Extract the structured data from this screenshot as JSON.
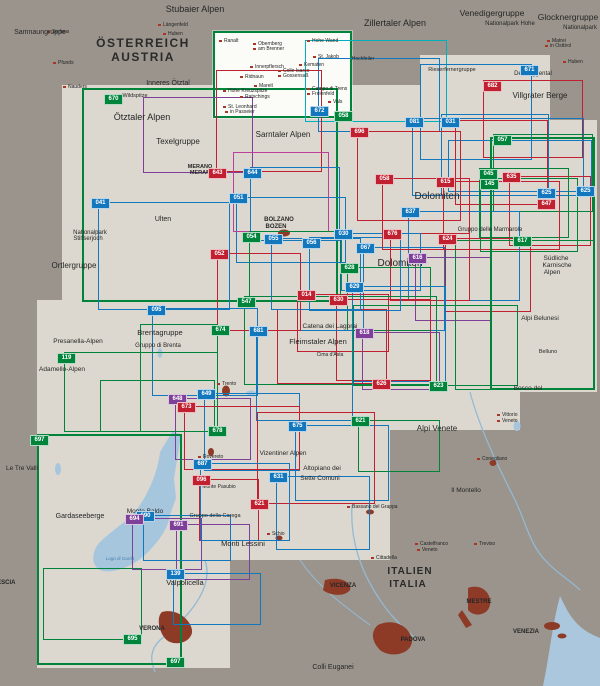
{
  "map_title": "Map sheet index overview – Südtirol / Dolomiten / Gardasee",
  "palette": {
    "b": "#1377bd",
    "r": "#c0202f",
    "g": "#00843c",
    "p": "#7d3f98",
    "m": "#bb3f9b",
    "c": "#00b0bd"
  },
  "water_color": "#a6c6de",
  "city_color": "#8d3a27",
  "coverage": [
    [
      62,
      85,
      483,
      230,
      false
    ],
    [
      37,
      300,
      483,
      130,
      false
    ],
    [
      37,
      430,
      353,
      130,
      false
    ],
    [
      37,
      560,
      193,
      108,
      false
    ],
    [
      420,
      55,
      130,
      90,
      false
    ],
    [
      448,
      120,
      149,
      272,
      false
    ],
    [
      213,
      31,
      139,
      87,
      true
    ]
  ],
  "sheets": [
    {
      "c": "g",
      "x": 213,
      "y": 31,
      "w": 139,
      "h": 87,
      "bw": 2
    },
    {
      "c": "g",
      "x": 82,
      "y": 88,
      "w": 256,
      "h": 214,
      "bw": 2
    },
    {
      "c": "c",
      "x": 305,
      "y": 40,
      "w": 142,
      "h": 82
    },
    {
      "c": "b",
      "x": 318,
      "y": 58,
      "w": 122,
      "h": 74
    },
    {
      "c": "r",
      "x": 216,
      "y": 70,
      "w": 106,
      "h": 102
    },
    {
      "c": "b",
      "x": 420,
      "y": 64,
      "w": 112,
      "h": 96
    },
    {
      "c": "r",
      "x": 483,
      "y": 80,
      "w": 100,
      "h": 78
    },
    {
      "c": "b",
      "x": 412,
      "y": 118,
      "w": 172,
      "h": 78
    },
    {
      "c": "b",
      "x": 441,
      "y": 114,
      "w": 108,
      "h": 82
    },
    {
      "c": "b",
      "x": 448,
      "y": 140,
      "w": 144,
      "h": 52
    },
    {
      "c": "r",
      "x": 455,
      "y": 120,
      "w": 93,
      "h": 85
    },
    {
      "c": "g",
      "x": 493,
      "y": 134,
      "w": 100,
      "h": 78
    },
    {
      "c": "r",
      "x": 509,
      "y": 176,
      "w": 82,
      "h": 70
    },
    {
      "c": "g",
      "x": 479,
      "y": 168,
      "w": 90,
      "h": 70
    },
    {
      "c": "g",
      "x": 480,
      "y": 178,
      "w": 98,
      "h": 74
    },
    {
      "c": "r",
      "x": 443,
      "y": 181,
      "w": 117,
      "h": 69
    },
    {
      "c": "b",
      "x": 408,
      "y": 211,
      "w": 112,
      "h": 90
    },
    {
      "c": "r",
      "x": 445,
      "y": 238,
      "w": 86,
      "h": 74
    },
    {
      "c": "p",
      "x": 415,
      "y": 257,
      "w": 76,
      "h": 64
    },
    {
      "c": "g",
      "x": 455,
      "y": 240,
      "w": 140,
      "h": 150
    },
    {
      "c": "g",
      "x": 490,
      "y": 137,
      "w": 105,
      "h": 253,
      "bw": 2.5
    },
    {
      "c": "r",
      "x": 390,
      "y": 233,
      "w": 80,
      "h": 68
    },
    {
      "c": "b",
      "x": 341,
      "y": 233,
      "w": 80,
      "h": 58
    },
    {
      "c": "b",
      "x": 363,
      "y": 247,
      "w": 82,
      "h": 84
    },
    {
      "c": "g",
      "x": 347,
      "y": 267,
      "w": 84,
      "h": 64
    },
    {
      "c": "b",
      "x": 352,
      "y": 286,
      "w": 94,
      "h": 96
    },
    {
      "c": "r",
      "x": 336,
      "y": 299,
      "w": 95,
      "h": 82
    },
    {
      "c": "r",
      "x": 297,
      "y": 294,
      "w": 92,
      "h": 58
    },
    {
      "c": "p",
      "x": 362,
      "y": 332,
      "w": 78,
      "h": 58
    },
    {
      "c": "r",
      "x": 277,
      "y": 309,
      "w": 110,
      "h": 75
    },
    {
      "c": "g",
      "x": 244,
      "y": 296,
      "w": 193,
      "h": 89
    },
    {
      "c": "g",
      "x": 353,
      "y": 305,
      "w": 165,
      "h": 81
    },
    {
      "c": "b",
      "x": 256,
      "y": 330,
      "w": 97,
      "h": 91
    },
    {
      "c": "b",
      "x": 236,
      "y": 197,
      "w": 110,
      "h": 66
    },
    {
      "c": "b",
      "x": 271,
      "y": 238,
      "w": 90,
      "h": 72
    },
    {
      "c": "b",
      "x": 309,
      "y": 237,
      "w": 92,
      "h": 74
    },
    {
      "c": "b",
      "x": 250,
      "y": 167,
      "w": 90,
      "h": 74
    },
    {
      "c": "r",
      "x": 357,
      "y": 131,
      "w": 104,
      "h": 90
    },
    {
      "c": "r",
      "x": 382,
      "y": 178,
      "w": 88,
      "h": 72
    },
    {
      "c": "r",
      "x": 217,
      "y": 253,
      "w": 84,
      "h": 78
    },
    {
      "c": "p",
      "x": 143,
      "y": 97,
      "w": 110,
      "h": 76
    },
    {
      "c": "m",
      "x": 233,
      "y": 152,
      "w": 96,
      "h": 80
    },
    {
      "c": "b",
      "x": 98,
      "y": 202,
      "w": 132,
      "h": 108
    },
    {
      "c": "b",
      "x": 152,
      "y": 308,
      "w": 106,
      "h": 88
    },
    {
      "c": "g",
      "x": 249,
      "y": 231,
      "w": 92,
      "h": 70
    },
    {
      "c": "g",
      "x": 64,
      "y": 352,
      "w": 154,
      "h": 80
    },
    {
      "c": "g",
      "x": 140,
      "y": 324,
      "w": 78,
      "h": 108
    },
    {
      "c": "b",
      "x": 204,
      "y": 393,
      "w": 96,
      "h": 78
    },
    {
      "c": "p",
      "x": 175,
      "y": 398,
      "w": 76,
      "h": 62
    },
    {
      "c": "r",
      "x": 184,
      "y": 406,
      "w": 116,
      "h": 64
    },
    {
      "c": "g",
      "x": 100,
      "y": 380,
      "w": 115,
      "h": 52
    },
    {
      "c": "g",
      "x": 37,
      "y": 434,
      "w": 145,
      "h": 231,
      "bw": 2.5
    },
    {
      "c": "g",
      "x": 43,
      "y": 568,
      "w": 99,
      "h": 72
    },
    {
      "c": "b",
      "x": 295,
      "y": 425,
      "w": 94,
      "h": 76
    },
    {
      "c": "g",
      "x": 358,
      "y": 420,
      "w": 82,
      "h": 52
    },
    {
      "c": "r",
      "x": 257,
      "y": 412,
      "w": 118,
      "h": 92
    },
    {
      "c": "r",
      "x": 199,
      "y": 479,
      "w": 60,
      "h": 62
    },
    {
      "c": "b",
      "x": 200,
      "y": 463,
      "w": 90,
      "h": 78
    },
    {
      "c": "b",
      "x": 276,
      "y": 476,
      "w": 94,
      "h": 74
    },
    {
      "c": "b",
      "x": 143,
      "y": 515,
      "w": 88,
      "h": 46
    },
    {
      "c": "p",
      "x": 132,
      "y": 518,
      "w": 70,
      "h": 52
    },
    {
      "c": "p",
      "x": 176,
      "y": 524,
      "w": 74,
      "h": 56
    },
    {
      "c": "b",
      "x": 173,
      "y": 573,
      "w": 88,
      "h": 52
    }
  ],
  "badges": [
    {
      "n": "670",
      "c": "g",
      "x": 104,
      "y": 94
    },
    {
      "n": "672",
      "c": "b",
      "x": 310,
      "y": 106
    },
    {
      "n": "058",
      "c": "g",
      "x": 334,
      "y": 111
    },
    {
      "n": "671",
      "c": "b",
      "x": 520,
      "y": 65
    },
    {
      "n": "682",
      "c": "r",
      "x": 483,
      "y": 81
    },
    {
      "n": "643",
      "c": "r",
      "x": 208,
      "y": 168
    },
    {
      "n": "644",
      "c": "b",
      "x": 243,
      "y": 168
    },
    {
      "n": "696",
      "c": "r",
      "x": 350,
      "y": 127
    },
    {
      "n": "081",
      "c": "b",
      "x": 405,
      "y": 117
    },
    {
      "n": "031",
      "c": "b",
      "x": 441,
      "y": 117
    },
    {
      "n": "057",
      "c": "g",
      "x": 493,
      "y": 135
    },
    {
      "n": "635",
      "c": "r",
      "x": 502,
      "y": 172
    },
    {
      "n": "045",
      "c": "g",
      "x": 479,
      "y": 169
    },
    {
      "n": "145",
      "c": "g",
      "x": 480,
      "y": 179
    },
    {
      "n": "625",
      "c": "b",
      "x": 537,
      "y": 188
    },
    {
      "n": "625",
      "c": "b",
      "x": 576,
      "y": 186
    },
    {
      "n": "647",
      "c": "r",
      "x": 537,
      "y": 199
    },
    {
      "n": "615",
      "c": "r",
      "x": 436,
      "y": 177
    },
    {
      "n": "637",
      "c": "b",
      "x": 401,
      "y": 207
    },
    {
      "n": "058",
      "c": "r",
      "x": 375,
      "y": 174
    },
    {
      "n": "041",
      "c": "b",
      "x": 91,
      "y": 198
    },
    {
      "n": "051",
      "c": "b",
      "x": 229,
      "y": 193
    },
    {
      "n": "054",
      "c": "g",
      "x": 242,
      "y": 232
    },
    {
      "n": "055",
      "c": "b",
      "x": 264,
      "y": 234
    },
    {
      "n": "056",
      "c": "b",
      "x": 302,
      "y": 238
    },
    {
      "n": "030",
      "c": "b",
      "x": 334,
      "y": 229
    },
    {
      "n": "067",
      "c": "b",
      "x": 356,
      "y": 243
    },
    {
      "n": "676",
      "c": "r",
      "x": 383,
      "y": 229
    },
    {
      "n": "624",
      "c": "r",
      "x": 438,
      "y": 234
    },
    {
      "n": "616",
      "c": "p",
      "x": 408,
      "y": 253
    },
    {
      "n": "617",
      "c": "g",
      "x": 513,
      "y": 236
    },
    {
      "n": "628",
      "c": "g",
      "x": 340,
      "y": 263
    },
    {
      "n": "629",
      "c": "b",
      "x": 345,
      "y": 282
    },
    {
      "n": "630",
      "c": "r",
      "x": 329,
      "y": 295
    },
    {
      "n": "014",
      "c": "r",
      "x": 297,
      "y": 290
    },
    {
      "n": "618",
      "c": "p",
      "x": 355,
      "y": 328
    },
    {
      "n": "547",
      "c": "g",
      "x": 237,
      "y": 297
    },
    {
      "n": "681",
      "c": "b",
      "x": 249,
      "y": 326
    },
    {
      "n": "674",
      "c": "g",
      "x": 211,
      "y": 325
    },
    {
      "n": "052",
      "c": "r",
      "x": 210,
      "y": 249
    },
    {
      "n": "095",
      "c": "b",
      "x": 147,
      "y": 305
    },
    {
      "n": "119",
      "c": "g",
      "x": 57,
      "y": 353
    },
    {
      "n": "649",
      "c": "b",
      "x": 197,
      "y": 389
    },
    {
      "n": "648",
      "c": "p",
      "x": 168,
      "y": 394
    },
    {
      "n": "673",
      "c": "r",
      "x": 177,
      "y": 402
    },
    {
      "n": "678",
      "c": "g",
      "x": 208,
      "y": 426
    },
    {
      "n": "626",
      "c": "r",
      "x": 372,
      "y": 379
    },
    {
      "n": "623",
      "c": "g",
      "x": 429,
      "y": 381
    },
    {
      "n": "621",
      "c": "g",
      "x": 351,
      "y": 416
    },
    {
      "n": "675",
      "c": "b",
      "x": 288,
      "y": 421
    },
    {
      "n": "687",
      "c": "b",
      "x": 193,
      "y": 459
    },
    {
      "n": "096",
      "c": "r",
      "x": 192,
      "y": 475
    },
    {
      "n": "631",
      "c": "b",
      "x": 269,
      "y": 472
    },
    {
      "n": "690",
      "c": "b",
      "x": 136,
      "y": 511
    },
    {
      "n": "694",
      "c": "p",
      "x": 125,
      "y": 514
    },
    {
      "n": "691",
      "c": "p",
      "x": 169,
      "y": 520
    },
    {
      "n": "621",
      "c": "r",
      "x": 250,
      "y": 499
    },
    {
      "n": "139",
      "c": "b",
      "x": 166,
      "y": 569
    },
    {
      "n": "697",
      "c": "g",
      "x": 30,
      "y": 435
    },
    {
      "n": "697",
      "c": "g",
      "x": 166,
      "y": 657
    },
    {
      "n": "695",
      "c": "g",
      "x": 123,
      "y": 634
    }
  ],
  "labels": [
    {
      "t": "Stubaier Alpen",
      "x": 195,
      "y": 4,
      "s": 9
    },
    {
      "t": "Zillertaler Alpen",
      "x": 395,
      "y": 18,
      "s": 9
    },
    {
      "t": "Venedigergruppe",
      "x": 492,
      "y": 8,
      "s": 8.5
    },
    {
      "t": "Glocknergruppe",
      "x": 568,
      "y": 12,
      "s": 8.5
    },
    {
      "t": "Nationalpark Hohe",
      "x": 510,
      "y": 21,
      "s": 6
    },
    {
      "t": "Nationalpark",
      "x": 580,
      "y": 25,
      "s": 6
    },
    {
      "t": "Samnaungruppe",
      "x": 40,
      "y": 29,
      "s": 7
    },
    {
      "t": "ÖSTERREICH",
      "x": 143,
      "y": 36,
      "s": 12,
      "w": "600",
      "sp": 1.5,
      "c": "#2a2a2a"
    },
    {
      "t": "AUSTRIA",
      "x": 143,
      "y": 50,
      "s": 12,
      "w": "600",
      "sp": 1.5,
      "c": "#2a2a2a"
    },
    {
      "t": "Inneres Ötztal",
      "x": 168,
      "y": 80,
      "s": 7
    },
    {
      "t": "Wildspitze",
      "x": 135,
      "y": 93,
      "s": 5.5
    },
    {
      "t": "Ötztaler Alpen",
      "x": 142,
      "y": 112,
      "s": 9
    },
    {
      "t": "Texelgruppe",
      "x": 178,
      "y": 137,
      "s": 8
    },
    {
      "t": "Sarntaler Alpen",
      "x": 283,
      "y": 130,
      "s": 8
    },
    {
      "t": "MERANO",
      "x": 200,
      "y": 164,
      "s": 5.5,
      "w": "bold"
    },
    {
      "t": "MERAN",
      "x": 200,
      "y": 170,
      "s": 5.5,
      "w": "bold"
    },
    {
      "t": "Villgrater Berge",
      "x": 540,
      "y": 91,
      "s": 8
    },
    {
      "t": "Defereggental",
      "x": 533,
      "y": 71,
      "s": 6
    },
    {
      "t": "Rieserfernergruppe",
      "x": 452,
      "y": 67,
      "s": 5.5
    },
    {
      "t": "Hochfeiler",
      "x": 363,
      "y": 56,
      "s": 5
    },
    {
      "t": "Ortlergruppe",
      "x": 74,
      "y": 261,
      "s": 8
    },
    {
      "t": "Nationalpark",
      "x": 90,
      "y": 230,
      "s": 6
    },
    {
      "t": "Stilfserjoch",
      "x": 88,
      "y": 236,
      "s": 6
    },
    {
      "t": "Ulten",
      "x": 163,
      "y": 216,
      "s": 7
    },
    {
      "t": "BOLZANO",
      "x": 279,
      "y": 217,
      "s": 6,
      "w": "bold"
    },
    {
      "t": "BOZEN",
      "x": 276,
      "y": 224,
      "s": 6,
      "w": "bold"
    },
    {
      "t": "Dolomiten",
      "x": 437,
      "y": 191,
      "s": 10
    },
    {
      "t": "Dolomiten",
      "x": 400,
      "y": 258,
      "s": 10
    },
    {
      "t": "Gruppo delle Marmarole",
      "x": 490,
      "y": 227,
      "s": 6
    },
    {
      "t": "Südliche",
      "x": 556,
      "y": 255,
      "s": 6.5
    },
    {
      "t": "Karnische",
      "x": 557,
      "y": 262,
      "s": 6.5
    },
    {
      "t": "Alpen",
      "x": 552,
      "y": 269,
      "s": 6.5
    },
    {
      "t": "Alpi Belunesi",
      "x": 540,
      "y": 315,
      "s": 6.5
    },
    {
      "t": "Belluno",
      "x": 548,
      "y": 349,
      "s": 5.5
    },
    {
      "t": "Catena dei Lagorai",
      "x": 330,
      "y": 323,
      "s": 6.5
    },
    {
      "t": "Fleimstaler Alpen",
      "x": 318,
      "y": 337,
      "s": 7.5
    },
    {
      "t": "Cima d'Asta",
      "x": 330,
      "y": 352,
      "s": 5
    },
    {
      "t": "Brentagruppe",
      "x": 160,
      "y": 328,
      "s": 7.5
    },
    {
      "t": "Gruppo di Brenta",
      "x": 158,
      "y": 343,
      "s": 6
    },
    {
      "t": "Presanella-Alpen",
      "x": 78,
      "y": 338,
      "s": 6.5
    },
    {
      "t": "Adamello-Alpen",
      "x": 62,
      "y": 366,
      "s": 6.5
    },
    {
      "t": "Le Tre Valli",
      "x": 22,
      "y": 465,
      "s": 6.5
    },
    {
      "t": "Gardaseeberge",
      "x": 80,
      "y": 513,
      "s": 7
    },
    {
      "t": "Monte Baldo",
      "x": 145,
      "y": 508,
      "s": 6.5
    },
    {
      "t": "Gruppo della Carega",
      "x": 215,
      "y": 513,
      "s": 5.5
    },
    {
      "t": "Monte Pasubio",
      "x": 219,
      "y": 484,
      "s": 5
    },
    {
      "t": "Monti Lessini",
      "x": 243,
      "y": 539,
      "s": 7.5
    },
    {
      "t": "Valpolicella",
      "x": 185,
      "y": 578,
      "s": 7.5
    },
    {
      "t": "Vizentiner Alpen",
      "x": 283,
      "y": 450,
      "s": 6.5
    },
    {
      "t": "Altopiano dei",
      "x": 322,
      "y": 465,
      "s": 6.5
    },
    {
      "t": "Sette Comuni",
      "x": 320,
      "y": 475,
      "s": 6.5
    },
    {
      "t": "Alpi Venete",
      "x": 437,
      "y": 424,
      "s": 8
    },
    {
      "t": "Bosco del",
      "x": 528,
      "y": 385,
      "s": 6.5
    },
    {
      "t": "Il Montello",
      "x": 466,
      "y": 487,
      "s": 6.5
    },
    {
      "t": "Colli Euganei",
      "x": 333,
      "y": 664,
      "s": 7
    },
    {
      "t": "ITALIEN",
      "x": 410,
      "y": 566,
      "s": 10,
      "w": "600",
      "sp": 1,
      "c": "#2a2a2a"
    },
    {
      "t": "ITALIA",
      "x": 408,
      "y": 579,
      "s": 10,
      "w": "600",
      "sp": 1,
      "c": "#2a2a2a"
    },
    {
      "t": "VERONA",
      "x": 152,
      "y": 626,
      "s": 6,
      "w": "bold"
    },
    {
      "t": "VICENZA",
      "x": 343,
      "y": 583,
      "s": 6,
      "w": "bold"
    },
    {
      "t": "PADOVA",
      "x": 413,
      "y": 637,
      "s": 6,
      "w": "bold"
    },
    {
      "t": "MESTRE",
      "x": 479,
      "y": 599,
      "s": 6,
      "w": "bold"
    },
    {
      "t": "VENEZIA",
      "x": 526,
      "y": 629,
      "s": 6,
      "w": "bold"
    },
    {
      "t": "BRESCIA",
      "x": 2,
      "y": 580,
      "s": 6,
      "w": "bold"
    },
    {
      "t": "Lago di Garda",
      "x": 120,
      "y": 556,
      "s": 4.5,
      "c": "#4a7fae",
      "i": true
    }
  ],
  "towns": [
    {
      "t": "Ranalt",
      "x": 224,
      "y": 38
    },
    {
      "t": "Obernberg",
      "x": 258,
      "y": 41
    },
    {
      "t": "am Brenner",
      "x": 258,
      "y": 46
    },
    {
      "t": "Hohe Wand",
      "x": 312,
      "y": 38
    },
    {
      "t": "St. Jakob",
      "x": 318,
      "y": 54
    },
    {
      "t": "Kematen",
      "x": 304,
      "y": 62
    },
    {
      "t": "Innerpflersch",
      "x": 255,
      "y": 64
    },
    {
      "t": "Colle Isarco",
      "x": 283,
      "y": 68
    },
    {
      "t": "Gossensaß",
      "x": 283,
      "y": 73
    },
    {
      "t": "Ridnaun",
      "x": 245,
      "y": 74
    },
    {
      "t": "Mareit",
      "x": 259,
      "y": 83
    },
    {
      "t": "Hohe Kreuzspitze",
      "x": 228,
      "y": 88
    },
    {
      "t": "Ratschings",
      "x": 245,
      "y": 94
    },
    {
      "t": "St. Leonhard",
      "x": 228,
      "y": 104
    },
    {
      "t": "in Passeier",
      "x": 230,
      "y": 109
    },
    {
      "t": "Campo di Trens",
      "x": 312,
      "y": 86
    },
    {
      "t": "Freienfeld",
      "x": 312,
      "y": 91
    },
    {
      "t": "Vals",
      "x": 333,
      "y": 99
    },
    {
      "t": "Pfunds",
      "x": 58,
      "y": 60
    },
    {
      "t": "Nauders",
      "x": 68,
      "y": 84
    },
    {
      "t": "Serfaus",
      "x": 52,
      "y": 29
    },
    {
      "t": "Längenfeld",
      "x": 163,
      "y": 22
    },
    {
      "t": "Huben",
      "x": 168,
      "y": 31
    },
    {
      "t": "Matrei",
      "x": 552,
      "y": 38
    },
    {
      "t": "in Osttirol",
      "x": 550,
      "y": 43
    },
    {
      "t": "Huben",
      "x": 568,
      "y": 59
    },
    {
      "t": "Trento",
      "x": 222,
      "y": 381
    },
    {
      "t": "Rovereto",
      "x": 203,
      "y": 454
    },
    {
      "t": "Vittorio",
      "x": 502,
      "y": 412
    },
    {
      "t": "Veneto",
      "x": 502,
      "y": 418
    },
    {
      "t": "Conegliano",
      "x": 482,
      "y": 456
    },
    {
      "t": "Treviso",
      "x": 479,
      "y": 541
    },
    {
      "t": "Castelfranco",
      "x": 420,
      "y": 541
    },
    {
      "t": "Veneto",
      "x": 422,
      "y": 547
    },
    {
      "t": "Cittadella",
      "x": 376,
      "y": 555
    },
    {
      "t": "Bassano del Grappa",
      "x": 352,
      "y": 504
    },
    {
      "t": "Schio",
      "x": 272,
      "y": 531
    }
  ]
}
